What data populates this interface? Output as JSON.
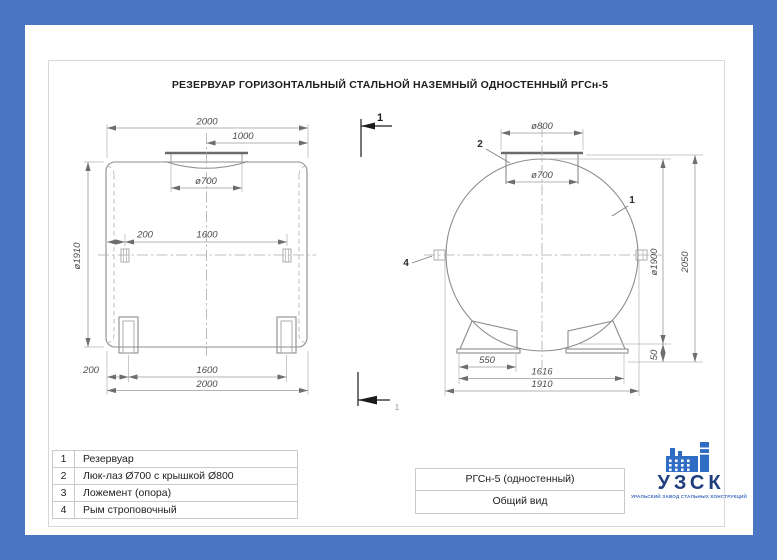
{
  "drawing_title": "РЕЗЕРВУАР ГОРИЗОНТАЛЬНЫЙ СТАЛЬНОЙ НАЗЕМНЫЙ ОДНОСТЕННЫЙ РГСн-5",
  "section_marks": {
    "top": "1",
    "bottom": "1"
  },
  "left_view": {
    "dim_overall_top": "2000",
    "dim_half": "1000",
    "dim_manhole": "ø700",
    "dim_shell_diameter": "ø1910",
    "dim_lug_offset": "200",
    "dim_lug_spacing": "1600",
    "dim_support_offset": "200",
    "dim_support_spacing": "1600",
    "dim_overall_bottom": "2000"
  },
  "right_view": {
    "dim_cover": "ø800",
    "dim_manhole": "ø700",
    "dim_shell_diameter": "ø1900",
    "dim_overall_height": "2050",
    "dim_support_width": "550",
    "dim_support_span": "1616",
    "dim_base_span": "1910",
    "dim_clearance": "50",
    "label_shell": "1",
    "label_hatch": "2",
    "label_lug": "4"
  },
  "parts_table": {
    "rows": [
      {
        "num": "1",
        "name": "Резервуар"
      },
      {
        "num": "2",
        "name": "Люк-лаз Ø700 с крышкой Ø800"
      },
      {
        "num": "3",
        "name": "Ложемент (опора)"
      },
      {
        "num": "4",
        "name": "Рым строповочный"
      }
    ]
  },
  "title_block": {
    "product": "РГСн-5 (одностенный)",
    "view_name": "Общий вид"
  },
  "logo": {
    "abbr": "УЗСК",
    "tagline": "УРАЛЬСКИЙ ЗАВОД СТАЛЬНЫХ КОНСТРУКЦИЙ"
  },
  "colors": {
    "border_blue": "#4a76c4",
    "logo_navy": "#1e3f7e",
    "logo_blue": "#2f6cc3"
  }
}
